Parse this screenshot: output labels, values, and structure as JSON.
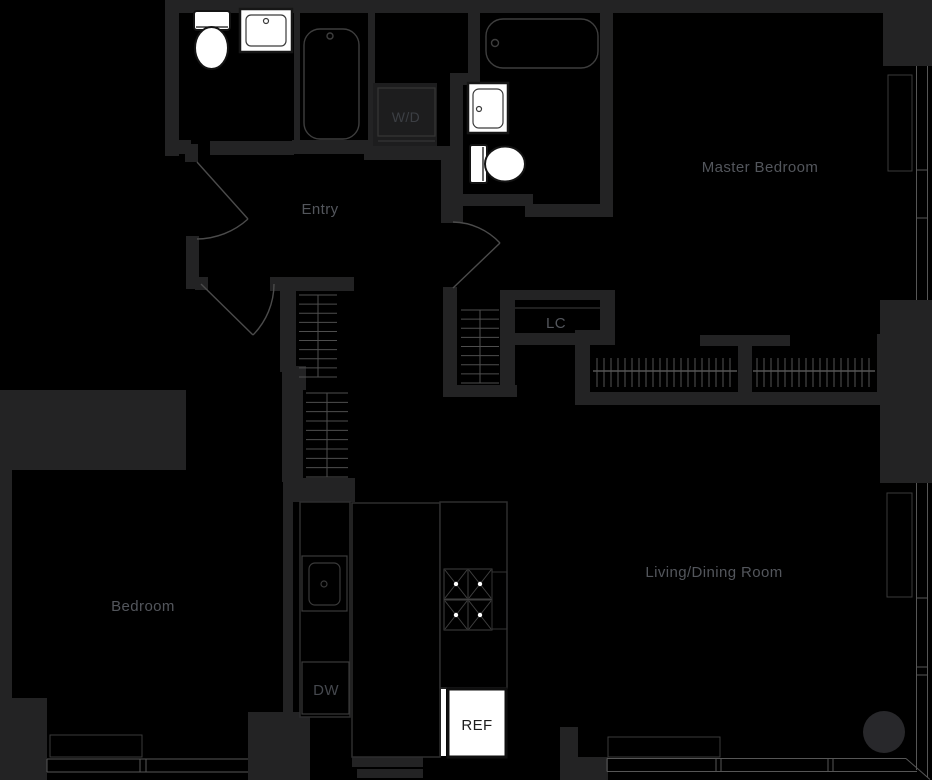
{
  "plan": {
    "type": "apartment-floor-plan",
    "rooms": [
      {
        "name": "entry",
        "label": "Entry"
      },
      {
        "name": "master-bedroom",
        "label": "Master Bedroom"
      },
      {
        "name": "bedroom",
        "label": "Bedroom"
      },
      {
        "name": "living-dining-room",
        "label": "Living/Dining Room"
      },
      {
        "name": "linen-closet",
        "label": "LC"
      }
    ],
    "appliances": [
      {
        "name": "washer-dryer",
        "label": "W/D"
      },
      {
        "name": "dishwasher",
        "label": "DW"
      },
      {
        "name": "refrigerator",
        "label": "REF"
      }
    ],
    "fixtures": [
      "toilet",
      "sink",
      "bathtub",
      "stove",
      "kitchen-sink"
    ],
    "colors": {
      "background": "#000000",
      "wall": "#232324",
      "wall_nook": "#1d1d1e",
      "room_label": "#53565c",
      "fixture_outline": "#3e3e3e",
      "fixture_fill": "#ffffff",
      "window_line": "#565656",
      "door_line": "#4b4b4b",
      "column": "#28282b"
    }
  }
}
